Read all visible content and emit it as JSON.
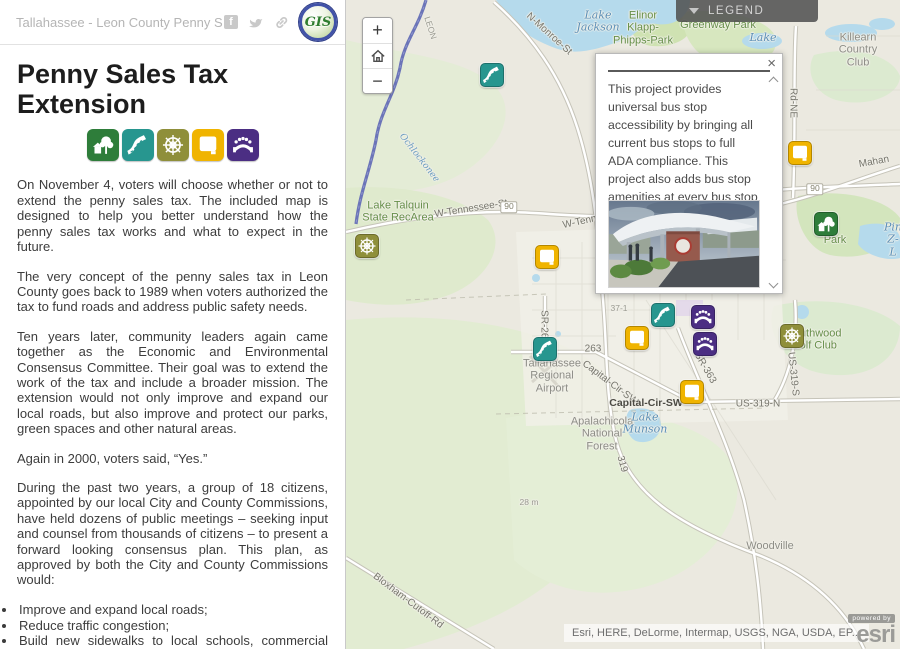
{
  "panel": {
    "header": {
      "title": "Tallahassee - Leon County Penny Sales...",
      "icons": [
        "facebook-icon",
        "twitter-icon",
        "share-link-icon"
      ],
      "logo_text": "GIS"
    },
    "title": "Penny Sales Tax Extension",
    "category_icons": [
      {
        "type": "parks"
      },
      {
        "type": "roads"
      },
      {
        "type": "core"
      },
      {
        "type": "sidewalks"
      },
      {
        "type": "transit"
      }
    ],
    "paragraphs": [
      "On November 4, voters will choose whether or not to extend the penny sales tax. The included map is designed to help you better understand how the penny sales tax works and what to expect in the future.",
      "The very concept of the penny sales tax in Leon County goes back to 1989 when voters authorized the tax to fund roads and address public safety needs.",
      "Ten years later, community leaders again came together as the Economic and Environmental Consensus Committee. Their goal was to extend the work of the tax and include a broader mission. The extension would not only improve and expand our local roads, but also improve and protect our parks, green spaces and other natural areas.",
      "Again in 2000, voters said, “Yes.”",
      "During the past two years, a group of 18 citizens, appointed by our local City and County Commissions, have held dozens of public meetings – seeking input and counsel from thousands of citizens – to present a forward looking consensus plan. This plan, as approved by both the City and County Commissions would:"
    ],
    "bullets": [
      "Improve and expand local roads;",
      "Reduce traffic congestion;",
      "Build new sidewalks to local schools, commercial areas and recreational amenities;",
      "Target projects in all parts of Leon County;"
    ]
  },
  "map": {
    "legend_label": "LEGEND",
    "controls": {
      "zoom_in": "+",
      "zoom_out": "−"
    },
    "popup": {
      "close_label": "×",
      "body": "This project provides universal bus stop accessibility by bringing all current bus stops to full ADA compliance. This project also adds bus stop amenities at every bus stop to enhance customer comfort.",
      "link": "More information on this project.",
      "image_alt": "bus-transit-station-rendering"
    },
    "attribution": "Esri, HERE, DeLorme, Intermap, USGS, NGA, USDA, EP...",
    "esri": {
      "powered_by": "powered by",
      "wordmark": "esri"
    },
    "labels": [
      {
        "text": "Lake\nJackson",
        "x": 252,
        "y": 22,
        "cls": "water",
        "rot": 0
      },
      {
        "text": "Elinor\nKlapp-\nPhipps-Park",
        "x": 297,
        "y": 28,
        "cls": "park",
        "rot": 0
      },
      {
        "text": "Greenway Park",
        "x": 372,
        "y": 25,
        "cls": "park",
        "rot": 0
      },
      {
        "text": "Lake",
        "x": 417,
        "y": 38,
        "cls": "water",
        "rot": 0
      },
      {
        "text": "Killearn\nCountry\nClub",
        "x": 512,
        "y": 50,
        "cls": "place",
        "rot": 0
      },
      {
        "text": "N-Monroe-St",
        "x": 203,
        "y": 34,
        "cls": "road",
        "rot": 42
      },
      {
        "text": "LEON",
        "x": 84,
        "y": 28,
        "cls": "tiny",
        "rot": 72
      },
      {
        "text": "Ochlockonee",
        "x": 73,
        "y": 158,
        "cls": "water-sm",
        "rot": 52
      },
      {
        "text": "W-Tennessee-St",
        "x": 125,
        "y": 209,
        "cls": "road",
        "rot": -9
      },
      {
        "text": "90",
        "x": 163,
        "y": 207,
        "cls": "shield",
        "rot": 0
      },
      {
        "text": "W-Tennessee-St",
        "x": 253,
        "y": 218,
        "cls": "road",
        "rot": -12
      },
      {
        "text": "Lake Talquin\nState RecArea",
        "x": 52,
        "y": 212,
        "cls": "park",
        "rot": 0
      },
      {
        "text": "Rd-NE",
        "x": 447,
        "y": 103,
        "cls": "road",
        "rot": 90
      },
      {
        "text": "Mahan",
        "x": 528,
        "y": 162,
        "cls": "road",
        "rot": -10
      },
      {
        "text": "90",
        "x": 469,
        "y": 189,
        "cls": "shield",
        "rot": 0
      },
      {
        "text": "Park",
        "x": 489,
        "y": 240,
        "cls": "park",
        "rot": 0
      },
      {
        "text": "Pin\nZ-L",
        "x": 547,
        "y": 240,
        "cls": "water",
        "rot": 0
      },
      {
        "text": "37-1",
        "x": 273,
        "y": 309,
        "cls": "tiny",
        "rot": 0
      },
      {
        "text": "SR-263",
        "x": 198,
        "y": 327,
        "cls": "road",
        "rot": 90
      },
      {
        "text": "263",
        "x": 247,
        "y": 349,
        "cls": "road",
        "rot": 0
      },
      {
        "text": "Tallahassee\nRegional\nAirport",
        "x": 206,
        "y": 376,
        "cls": "place",
        "rot": 0
      },
      {
        "text": "Capital-Cir-SW",
        "x": 264,
        "y": 383,
        "cls": "road",
        "rot": 37
      },
      {
        "text": "SR-363",
        "x": 359,
        "y": 368,
        "cls": "road",
        "rot": 60
      },
      {
        "text": "US-319-S",
        "x": 447,
        "y": 374,
        "cls": "road",
        "rot": 84
      },
      {
        "text": "Capital-Cir-SW",
        "x": 300,
        "y": 404,
        "cls": "road-dark",
        "rot": 0
      },
      {
        "text": "US-319-N",
        "x": 412,
        "y": 404,
        "cls": "road",
        "rot": 0
      },
      {
        "text": "Southwood\nGolf Club",
        "x": 468,
        "y": 340,
        "cls": "park",
        "rot": 0
      },
      {
        "text": "Apalachicola\nNational\nForest",
        "x": 256,
        "y": 434,
        "cls": "place",
        "rot": 0
      },
      {
        "text": "Lake\nMunson",
        "x": 299,
        "y": 424,
        "cls": "water",
        "rot": 0
      },
      {
        "text": "319",
        "x": 276,
        "y": 464,
        "cls": "road",
        "rot": 75
      },
      {
        "text": "28 m",
        "x": 183,
        "y": 503,
        "cls": "tiny",
        "rot": 0
      },
      {
        "text": "Woodville",
        "x": 424,
        "y": 546,
        "cls": "place",
        "rot": 0
      },
      {
        "text": "Bloxham-Cutoff-Rd",
        "x": 62,
        "y": 601,
        "cls": "road",
        "rot": 37
      }
    ],
    "markers": [
      {
        "type": "roads",
        "x": 146,
        "y": 75
      },
      {
        "type": "sidewalks",
        "x": 454,
        "y": 153
      },
      {
        "type": "parks",
        "x": 480,
        "y": 224
      },
      {
        "type": "core",
        "x": 21,
        "y": 246
      },
      {
        "type": "sidewalks",
        "x": 201,
        "y": 257
      },
      {
        "type": "roads",
        "x": 317,
        "y": 315
      },
      {
        "type": "transit",
        "x": 357,
        "y": 317
      },
      {
        "type": "sidewalks",
        "x": 291,
        "y": 338
      },
      {
        "type": "transit",
        "x": 359,
        "y": 344
      },
      {
        "type": "core",
        "x": 446,
        "y": 336
      },
      {
        "type": "roads",
        "x": 199,
        "y": 349
      },
      {
        "type": "sidewalks",
        "x": 346,
        "y": 392
      }
    ]
  },
  "icon_colors": {
    "parks": "#2e7d3a",
    "roads": "#27968f",
    "core": "#8f8f3a",
    "sidewalks": "#f0b400",
    "transit": "#4b2e83"
  },
  "colors": {
    "link_blue": "#17507e",
    "legend_bg": "#4e4e4e",
    "water_fill": "#b5daec",
    "park_fill": "#dfeacd"
  }
}
